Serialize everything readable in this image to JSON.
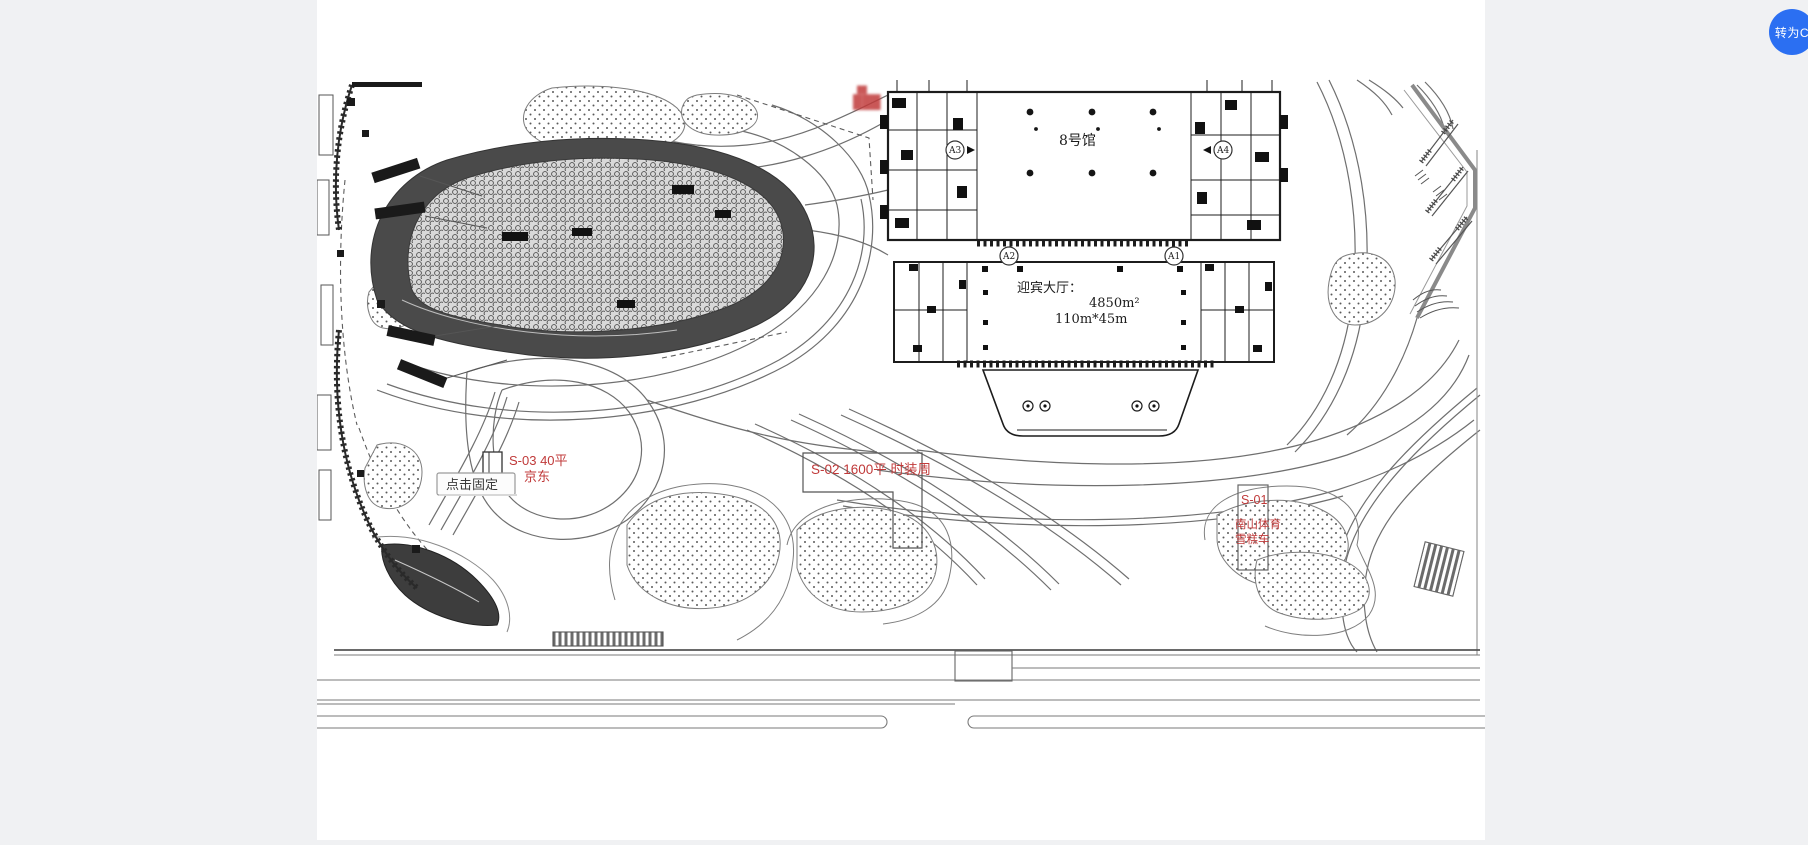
{
  "window": {
    "background": "#f0f1f3",
    "canvas_background": "#ffffff"
  },
  "floating_button": {
    "label": "转为C",
    "background": "#2b6ff2",
    "text_color": "#ffffff"
  },
  "plan": {
    "accent_red": "#c03a3a",
    "hall": {
      "name": "8号馆"
    },
    "lobby": {
      "title": "迎宾大厅：",
      "area": "4850m²",
      "dimensions": "110m*45m"
    },
    "grid_bubbles": {
      "a1": "A1",
      "a2": "A2",
      "a3": "A3",
      "a4": "A4"
    },
    "booth_s01": {
      "id": "S-01",
      "line2": "南山体育",
      "line3": "雪糕车"
    },
    "booth_s02": {
      "label": "S-02  1600平    时装周"
    },
    "booth_s03": {
      "line1": "S-03   40平",
      "line2": "京东"
    },
    "tooltip": {
      "label": "点击固定"
    },
    "illegible_label_top": "██",
    "illegible_label": "███"
  }
}
